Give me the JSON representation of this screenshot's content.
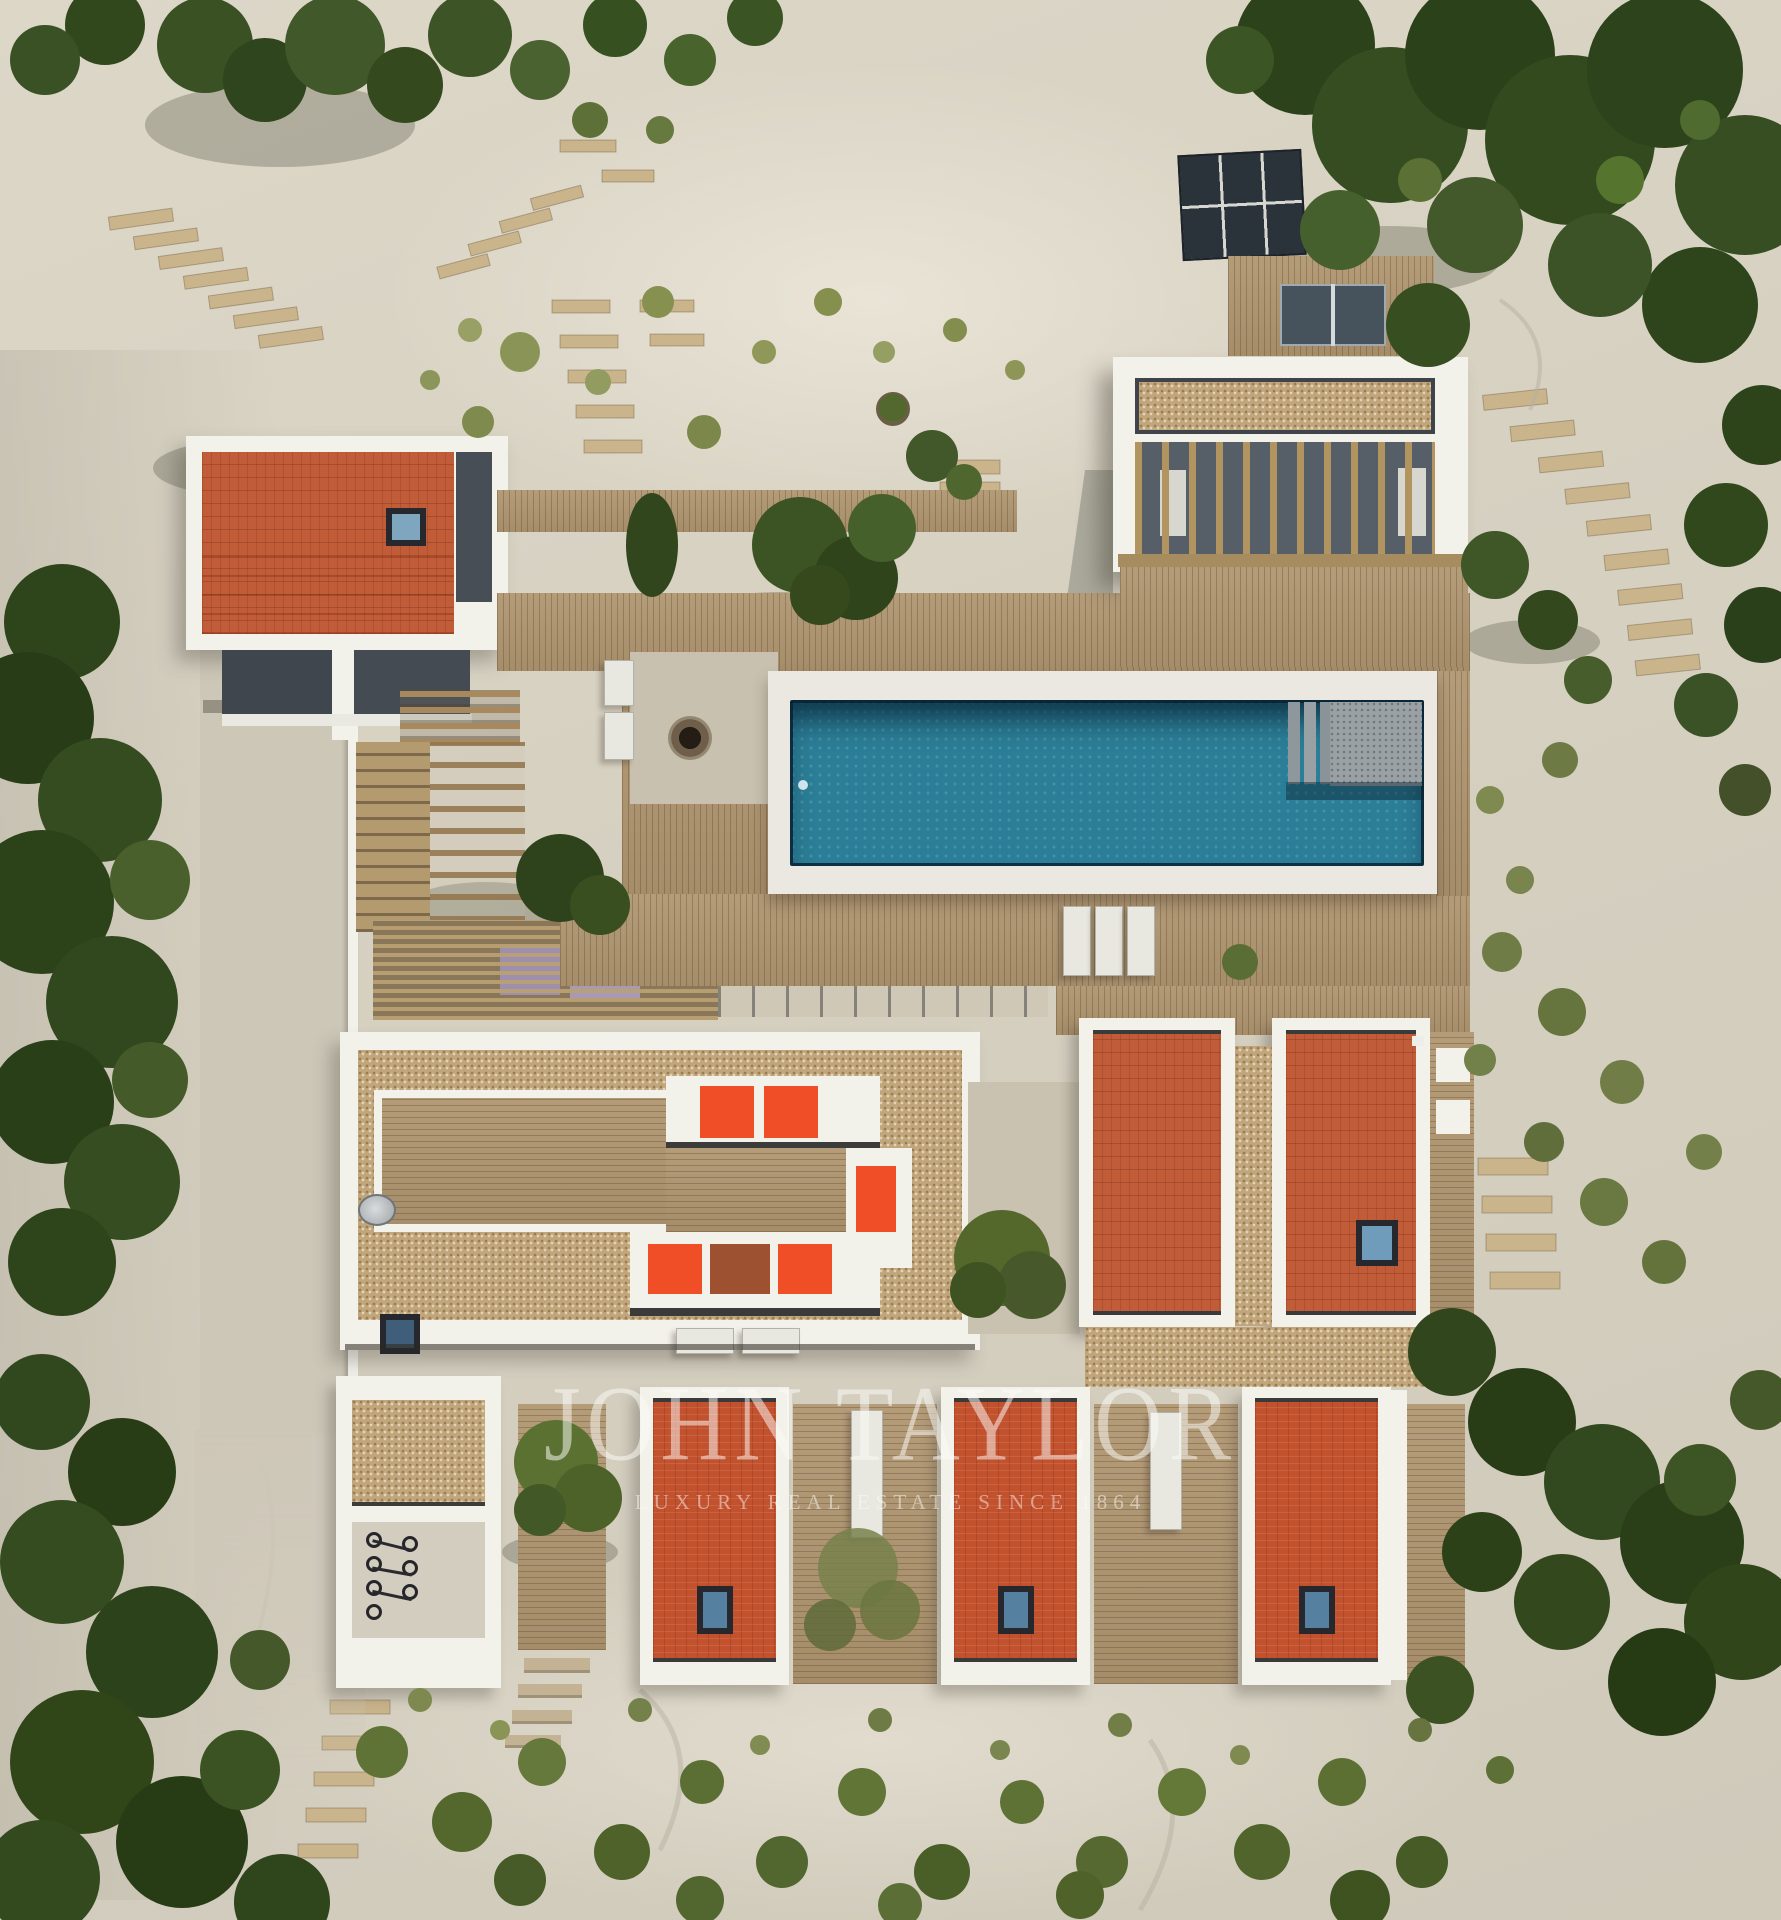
{
  "watermark": {
    "title": "JOHN TAYLOR",
    "subtitle": "LUXURY REAL ESTATE SINCE 1864"
  },
  "palette": {
    "sand": "#d8d2c3",
    "sand-light": "#e4decd",
    "sand-dark": "#bfb9a9",
    "white-structure": "#f2f1ea",
    "wood-deck": "#b09671",
    "wood-dark": "#8d7856",
    "gravel-roof": "#c2a67b",
    "terracotta-roof": "#c05c38",
    "red-roof": "#c2512e",
    "lounger-orange": "#f04e27",
    "pool-water": "#2b7e97",
    "pool-shadow": "#14394b",
    "stone-steps": "#9aa1a4",
    "glass-dark": "#474e55",
    "vegetation-dark": "#33471f",
    "vegetation": "#4c6230",
    "vegetation-light": "#74854b",
    "concrete": "#cdc7b8",
    "skylight-glass": "#5b87a8"
  }
}
